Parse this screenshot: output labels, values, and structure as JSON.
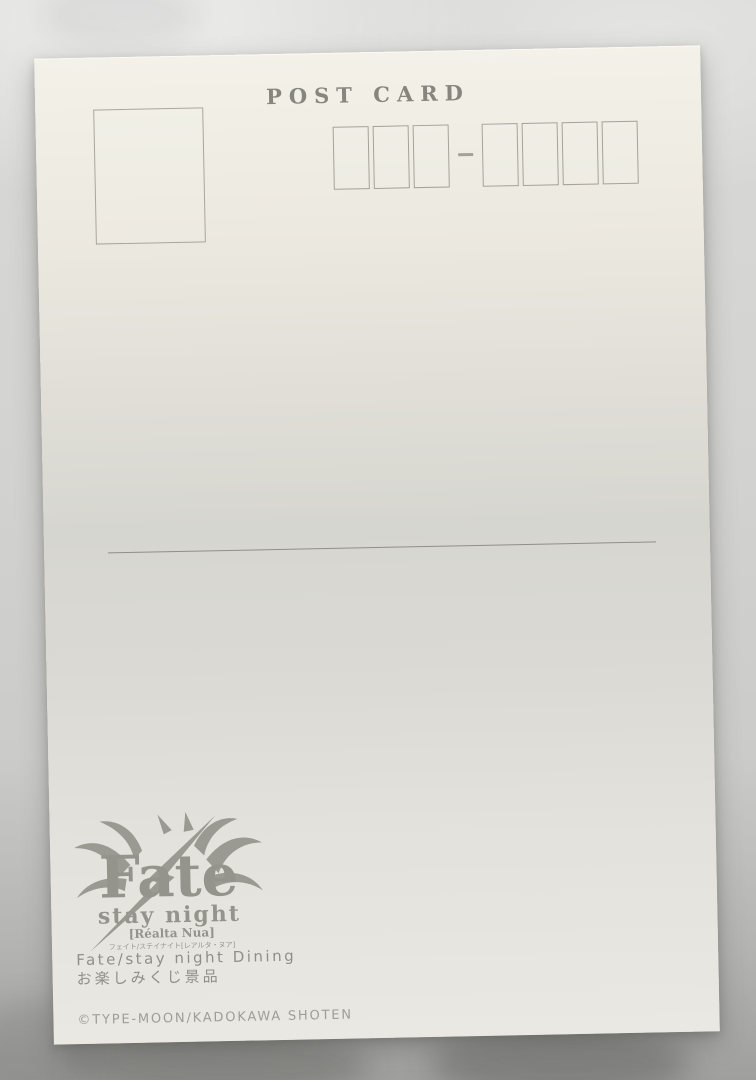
{
  "postcard": {
    "title": "POST CARD",
    "postal_code": {
      "boxes_before_dash": 3,
      "boxes_after_dash": 4,
      "separator": "-"
    },
    "logo": {
      "main": "Fate",
      "sub": "stay night",
      "edition": "[Réalta Nua]",
      "reading": "フェイト/ステイナイト[レアルタ・ヌア]"
    },
    "footer": {
      "line1": "Fate/stay night Dining",
      "line2": "お楽しみくじ景品",
      "copyright": "©TYPE-MOON/KADOKAWA SHOTEN"
    },
    "colors": {
      "card": "#ece9e0",
      "ink": "#86867f",
      "box_border": "#a5a399",
      "logo_ink": "#9a9a93",
      "photo_background": "#cfcfcd",
      "shadow": "#9f9f9d"
    }
  }
}
